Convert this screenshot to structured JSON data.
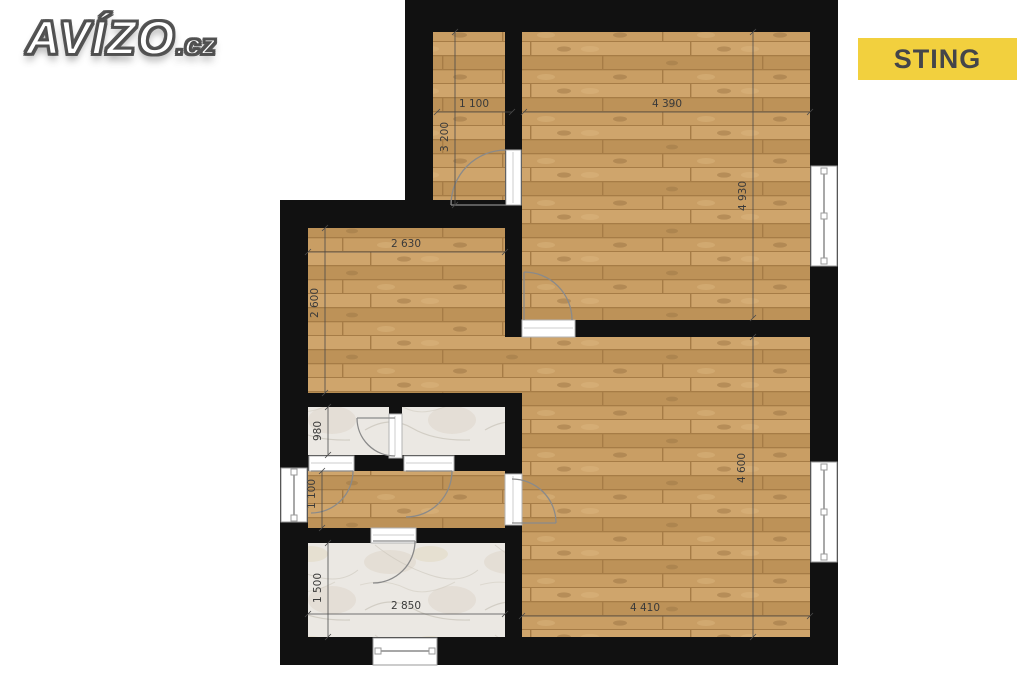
{
  "branding": {
    "site_name": "AVÍZO",
    "site_tld": ".cz",
    "agency_name": "STING"
  },
  "colors": {
    "wall": "#111111",
    "wood_floor": "#c59a62",
    "marble_floor": "#ebe8e3",
    "badge_background": "#f2d03e",
    "badge_text": "#44454a",
    "dimension_text": "#3a3a3a"
  },
  "floorplan": {
    "dimensions_mm": {
      "room_top_left_width": "1 100",
      "room_top_left_height": "3 200",
      "room_top_right_width": "4 390",
      "room_top_right_height": "4 930",
      "room_mid_left_width": "2 630",
      "room_mid_left_height": "2 600",
      "wc_height": "980",
      "hallway_height": "1 100",
      "bathroom_height": "1 500",
      "bathroom_width": "2 850",
      "room_bottom_right_width": "4 410",
      "room_bottom_right_height": "4 600"
    }
  }
}
